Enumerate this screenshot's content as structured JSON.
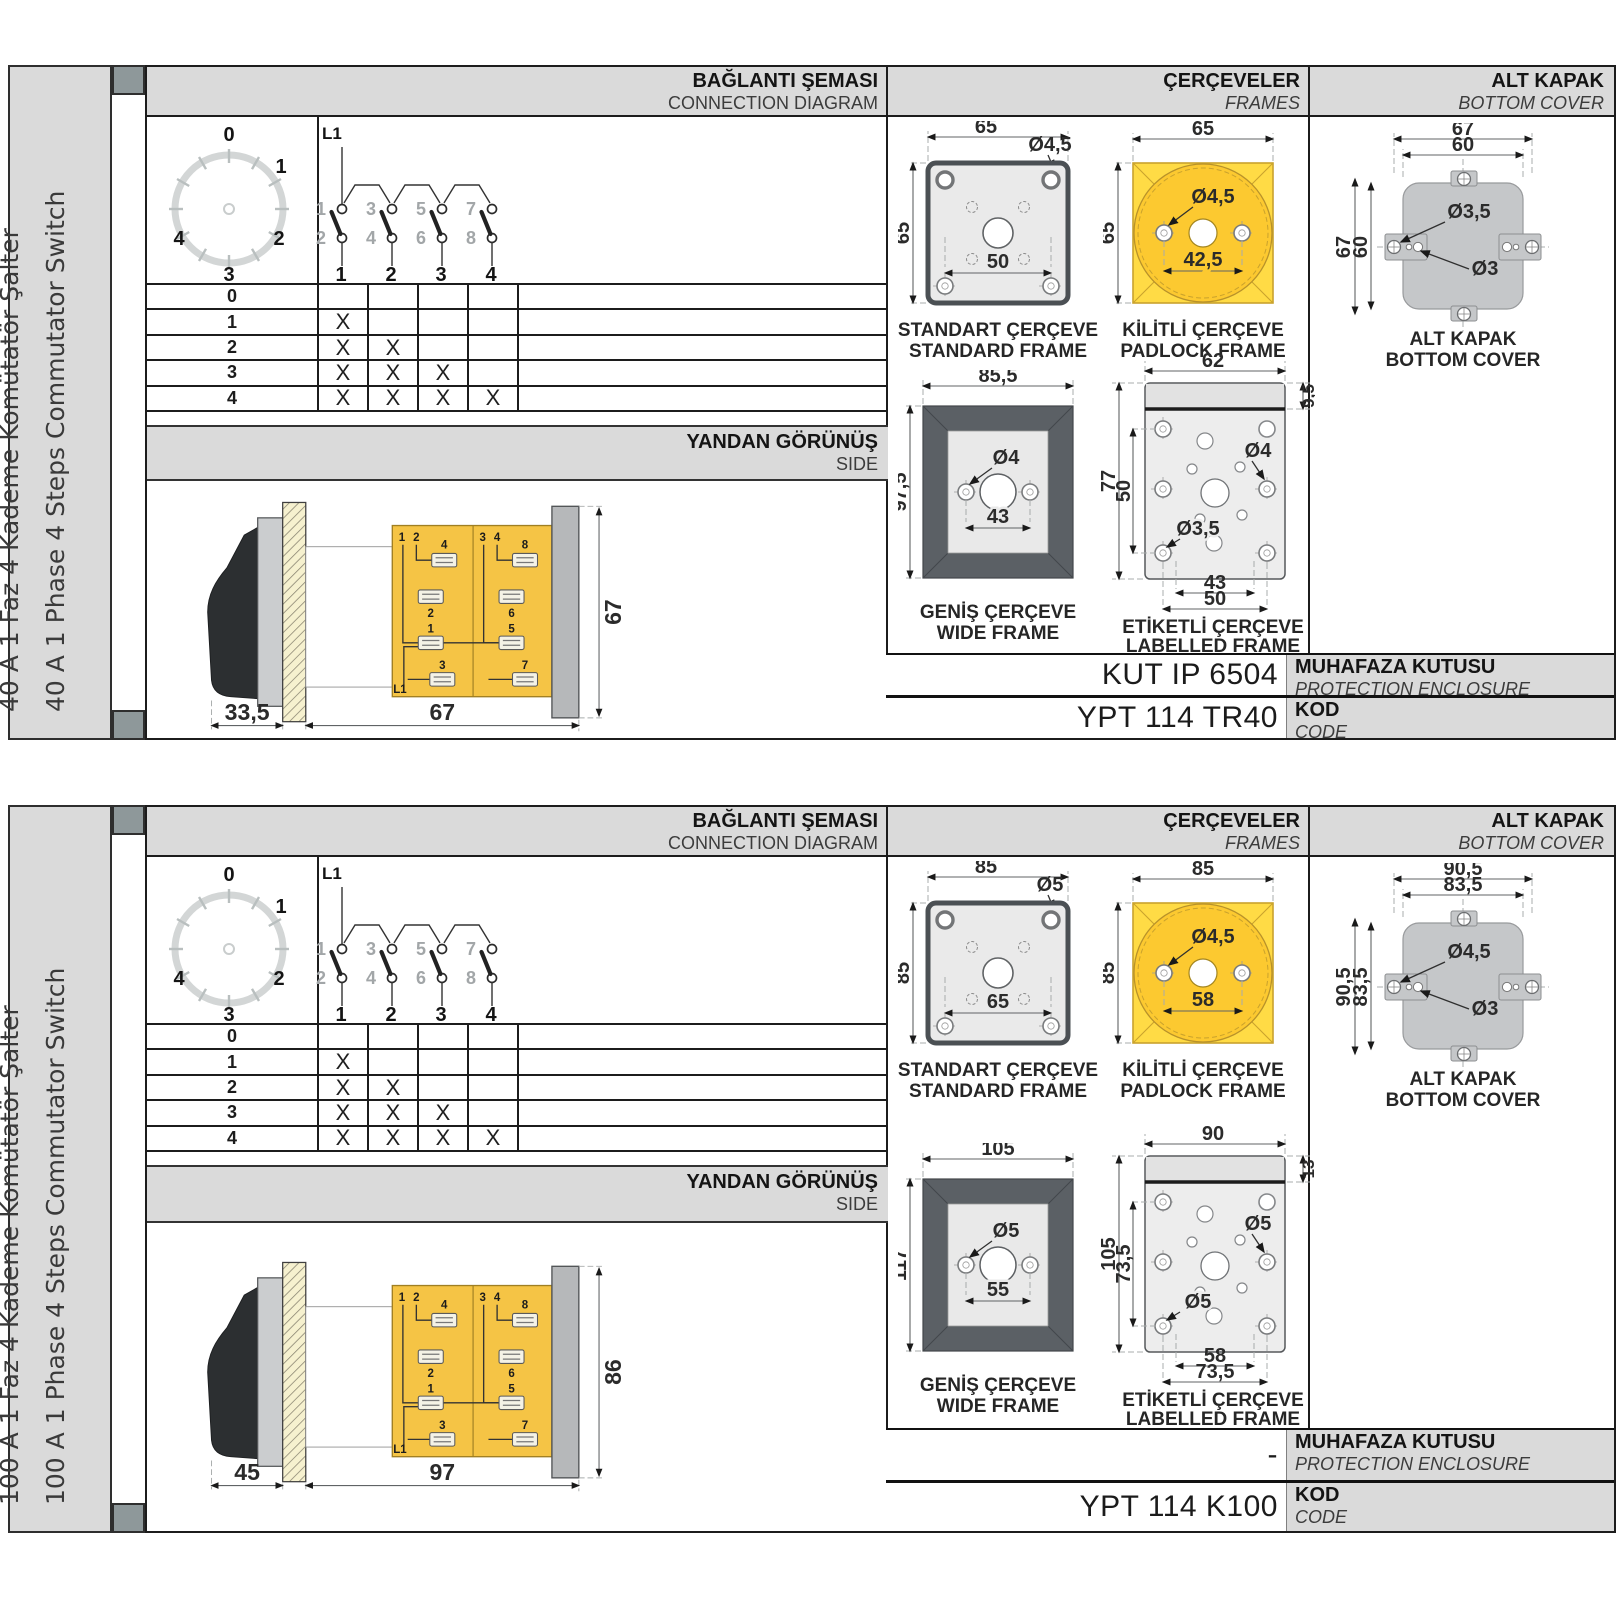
{
  "panels": [
    {
      "sidebar": {
        "tr": "40 A 1 Faz 4 Kademe Komütatör Şalter",
        "en": "40 A 1 Phase 4 Steps Commutator Switch"
      },
      "headers": {
        "connection_tr": "BAĞLANTI ŞEMASI",
        "connection_en": "CONNECTION DIAGRAM",
        "frames_tr": "ÇERÇEVELER",
        "frames_en": "FRAMES",
        "cover_tr": "ALT KAPAK",
        "cover_en": "BOTTOM COVER",
        "side_tr": "YANDAN GÖRÜNÜŞ",
        "side_en": "SIDE"
      },
      "dial": {
        "n0": "0",
        "n1": "1",
        "n2": "2",
        "n3": "3",
        "n4": "4"
      },
      "contact": {
        "line": "L1",
        "t1": "1",
        "t3": "3",
        "t5": "5",
        "t7": "7",
        "b2": "2",
        "b4": "4",
        "b6": "6",
        "b8": "8",
        "p1": "1",
        "p2": "2",
        "p3": "3",
        "p4": "4"
      },
      "table": {
        "rows": [
          {
            "label": "0",
            "m1": "",
            "m2": "",
            "m3": "",
            "m4": ""
          },
          {
            "label": "1",
            "m1": "X",
            "m2": "",
            "m3": "",
            "m4": ""
          },
          {
            "label": "2",
            "m1": "X",
            "m2": "X",
            "m3": "",
            "m4": ""
          },
          {
            "label": "3",
            "m1": "X",
            "m2": "X",
            "m3": "X",
            "m4": ""
          },
          {
            "label": "4",
            "m1": "X",
            "m2": "X",
            "m3": "X",
            "m4": "X"
          }
        ]
      },
      "side_view": {
        "front": "33,5",
        "depth": "67",
        "height": "67",
        "l1": "L1",
        "k1": "1",
        "k2": "2",
        "k3": "3",
        "k4": "4",
        "t1": "1",
        "t2": "2",
        "t3": "3",
        "t4": "4",
        "t5": "5",
        "t6": "6",
        "t7": "7",
        "t8": "8"
      },
      "frames": {
        "standard": {
          "w": "65",
          "h": "65",
          "hole": "Ø4,5",
          "cc": "50",
          "tr": "STANDART ÇERÇEVE",
          "en": "STANDARD FRAME"
        },
        "padlock": {
          "w": "65",
          "h": "65",
          "hole": "Ø4,5",
          "cc": "42,5",
          "tr": "KİLİTLİ ÇERÇEVE",
          "en": "PADLOCK FRAME"
        },
        "wide": {
          "w": "85,5",
          "h": "97,5",
          "hole": "Ø4",
          "cc": "43",
          "tr": "GENİŞ ÇERÇEVE",
          "en": "WIDE FRAME"
        },
        "labelled": {
          "w": "62",
          "h": "77",
          "inner": "50",
          "band": "9,5",
          "hole_right": "Ø4",
          "hole_inner": "Ø3,5",
          "cc1": "43",
          "cc2": "50",
          "tr": "ETİKETLİ ÇERÇEVE",
          "en": "LABELLED FRAME"
        }
      },
      "cover": {
        "w1": "67",
        "w2": "60",
        "h1": "67",
        "h2": "60",
        "hole1": "Ø3,5",
        "hole2": "Ø3",
        "tr": "ALT KAPAK",
        "en": "BOTTOM COVER"
      },
      "enclosure": {
        "value": "KUT IP 6504",
        "tr": "MUHAFAZA KUTUSU",
        "en": "PROTECTION ENCLOSURE"
      },
      "code": {
        "value": "YPT 114 TR40",
        "tr": "KOD",
        "en": "CODE"
      }
    },
    {
      "sidebar": {
        "tr": "100 A 1 Faz 4 Kademe Komütatör Şalter",
        "en": "100 A 1 Phase 4 Steps Commutator Switch"
      },
      "headers": {
        "connection_tr": "BAĞLANTI ŞEMASI",
        "connection_en": "CONNECTION DIAGRAM",
        "frames_tr": "ÇERÇEVELER",
        "frames_en": "FRAMES",
        "cover_tr": "ALT KAPAK",
        "cover_en": "BOTTOM COVER",
        "side_tr": "YANDAN GÖRÜNÜŞ",
        "side_en": "SIDE"
      },
      "dial": {
        "n0": "0",
        "n1": "1",
        "n2": "2",
        "n3": "3",
        "n4": "4"
      },
      "contact": {
        "line": "L1",
        "t1": "1",
        "t3": "3",
        "t5": "5",
        "t7": "7",
        "b2": "2",
        "b4": "4",
        "b6": "6",
        "b8": "8",
        "p1": "1",
        "p2": "2",
        "p3": "3",
        "p4": "4"
      },
      "table": {
        "rows": [
          {
            "label": "0",
            "m1": "",
            "m2": "",
            "m3": "",
            "m4": ""
          },
          {
            "label": "1",
            "m1": "X",
            "m2": "",
            "m3": "",
            "m4": ""
          },
          {
            "label": "2",
            "m1": "X",
            "m2": "X",
            "m3": "",
            "m4": ""
          },
          {
            "label": "3",
            "m1": "X",
            "m2": "X",
            "m3": "X",
            "m4": ""
          },
          {
            "label": "4",
            "m1": "X",
            "m2": "X",
            "m3": "X",
            "m4": "X"
          }
        ]
      },
      "side_view": {
        "front": "45",
        "depth": "97",
        "height": "86",
        "l1": "L1",
        "k1": "1",
        "k2": "2",
        "k3": "3",
        "k4": "4",
        "t1": "1",
        "t2": "2",
        "t3": "3",
        "t4": "4",
        "t5": "5",
        "t6": "6",
        "t7": "7",
        "t8": "8"
      },
      "frames": {
        "standard": {
          "w": "85",
          "h": "85",
          "hole": "Ø5",
          "cc": "65",
          "tr": "STANDART ÇERÇEVE",
          "en": "STANDARD FRAME"
        },
        "padlock": {
          "w": "85",
          "h": "85",
          "hole": "Ø4,5",
          "cc": "58",
          "tr": "KİLİTLİ ÇERÇEVE",
          "en": "PADLOCK FRAME"
        },
        "wide": {
          "w": "105",
          "h": "117",
          "hole": "Ø5",
          "cc": "55",
          "tr": "GENİŞ ÇERÇEVE",
          "en": "WIDE FRAME"
        },
        "labelled": {
          "w": "90",
          "h": "105",
          "inner": "73,5",
          "band": "13",
          "hole_right": "Ø5",
          "hole_inner": "Ø5",
          "cc1": "58",
          "cc2": "73,5",
          "tr": "ETİKETLİ ÇERÇEVE",
          "en": "LABELLED FRAME"
        }
      },
      "cover": {
        "w1": "90,5",
        "w2": "83,5",
        "h1": "90,5",
        "h2": "83,5",
        "hole1": "Ø4,5",
        "hole2": "Ø3",
        "tr": "ALT KAPAK",
        "en": "BOTTOM COVER"
      },
      "enclosure": {
        "value": "-",
        "tr": "MUHAFAZA KUTUSU",
        "en": "PROTECTION ENCLOSURE"
      },
      "code": {
        "value": "YPT 114 K100",
        "tr": "KOD",
        "en": "CODE"
      }
    }
  ]
}
